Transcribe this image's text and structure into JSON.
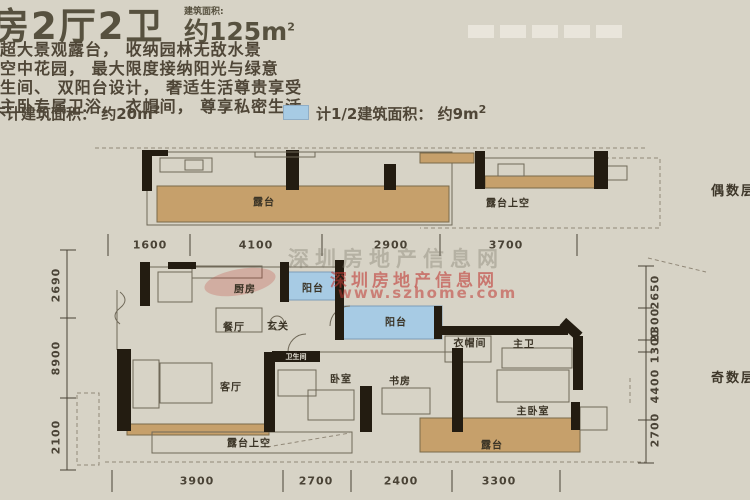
{
  "colors": {
    "bg": "#d7d3c6",
    "tan": "#c6a06b",
    "blue": "#a7cbe4",
    "wall": "#231c11",
    "line": "#6f6858",
    "dash": "#918878",
    "text": "#4b4435",
    "red": "#c03a35"
  },
  "header": {
    "title": "房2厅2卫",
    "area_label": "建筑面积:",
    "area_value": "约125m",
    "area_sup": "2",
    "features": [
      "的超大景观露台， 收纳园林无敌水景",
      "墅空中花园， 最大限度接纳阳光与绿意",
      "卫生间、 双阳台设计， 奢适生活尊贵享受",
      "半主卧专属卫浴、 衣帽间， 尊享私密生活"
    ]
  },
  "legend": {
    "item1": "不计建筑面积： 约20m",
    "item1_sup": "2",
    "item2": "计1/2建筑面积： 约9m",
    "item2_sup": "2"
  },
  "plan": {
    "rooms": [
      {
        "name": "terrace-top",
        "label": "露台"
      },
      {
        "name": "terrace-void-top",
        "label": "露台上空"
      },
      {
        "name": "kitchen",
        "label": "厨房"
      },
      {
        "name": "balcony-north",
        "label": "阳台"
      },
      {
        "name": "dining",
        "label": "餐厅"
      },
      {
        "name": "foyer",
        "label": "玄关"
      },
      {
        "name": "balcony-main",
        "label": "阳台"
      },
      {
        "name": "wardrobe",
        "label": "衣帽间"
      },
      {
        "name": "master-bath",
        "label": "主卫"
      },
      {
        "name": "bathroom",
        "label": "卫生间"
      },
      {
        "name": "living",
        "label": "客厅"
      },
      {
        "name": "bedroom",
        "label": "卧室"
      },
      {
        "name": "study",
        "label": "书房"
      },
      {
        "name": "master-bedroom",
        "label": "主卧室"
      },
      {
        "name": "terrace-bottom",
        "label": "露台"
      },
      {
        "name": "terrace-void-bottom",
        "label": "露台上空"
      }
    ],
    "floor_tags": {
      "even": "偶数层",
      "odd": "奇数层"
    },
    "dims_top": [
      "1600",
      "4100",
      "2900",
      "3700"
    ],
    "dims_bottom": [
      "3900",
      "2700",
      "2400",
      "3300"
    ],
    "dims_left": [
      "2690",
      "8900",
      "2100"
    ],
    "dims_right": [
      "2650",
      "2300",
      "1300",
      "4400",
      "2700"
    ]
  },
  "watermark": {
    "site_line": "深圳房地产信息网",
    "url_line": "www.szhome.com"
  }
}
